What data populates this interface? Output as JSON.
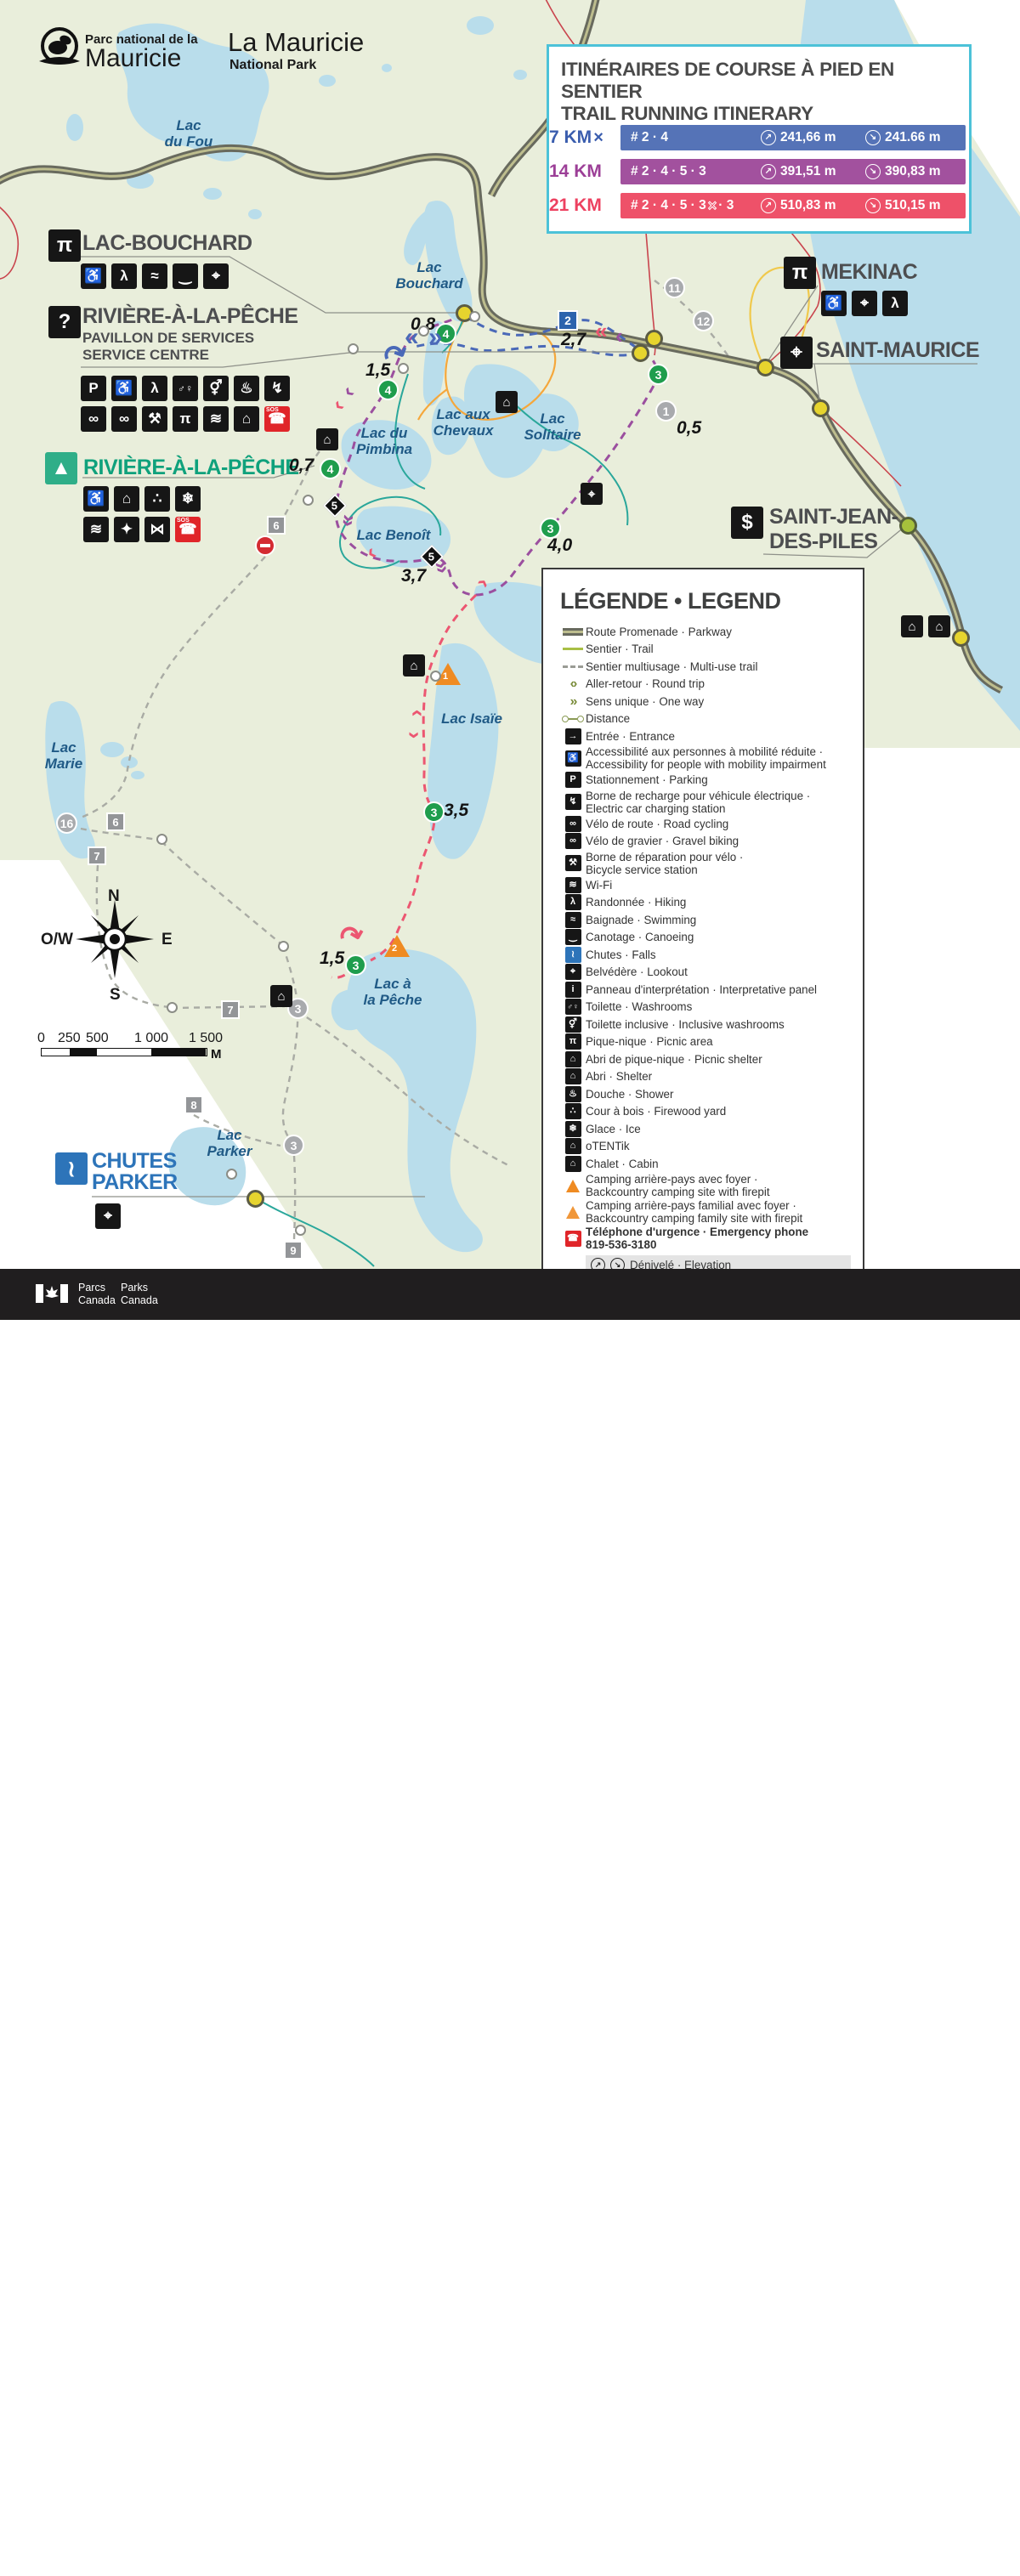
{
  "header": {
    "logo_fr_small": "Parc national de la",
    "logo_fr_big": "Mauricie",
    "logo_en_big": "La Mauricie",
    "logo_en_small": "National Park"
  },
  "itinerary": {
    "title_fr": "ITINÉRAIRES DE COURSE À PIED EN SENTIER",
    "title_en": "TRAIL RUNNING ITINERARY",
    "accent_border": "#4cc2d8",
    "rows": [
      {
        "distance": "7 KM",
        "cross": "×",
        "segments": "# 2 · 4",
        "gain": "241,66 m",
        "loss": "241.66 m",
        "color": "#5573b7"
      },
      {
        "distance": "14 KM",
        "segments": "# 2 · 4 · 5 · 3",
        "gain": "391,51 m",
        "loss": "390,83 m",
        "color": "#a2519e"
      },
      {
        "distance": "21 KM",
        "segments_pre": "# 2 · 4 · 5 · 3",
        "cross": "×",
        "segments_post": "· 3",
        "gain": "510,83 m",
        "loss": "510,15 m",
        "color": "#ee5169"
      }
    ],
    "gain_arrow": "↗",
    "loss_arrow": "↘"
  },
  "legend": {
    "title": "LÉGENDE • LEGEND",
    "items": [
      {
        "label": "Route Promenade · Parkway"
      },
      {
        "label": "Sentier · Trail"
      },
      {
        "label": "Sentier multiusage · Multi-use trail"
      },
      {
        "label": "Aller-retour · Round trip",
        "glyph": "‹›"
      },
      {
        "label": "Sens unique · One way",
        "glyph": "»"
      },
      {
        "label": "Distance"
      },
      {
        "label": "Entrée · Entrance",
        "glyph": "→"
      },
      {
        "label": "Accessibilité aux personnes à mobilité réduite ·\nAccessibility for people with mobility impairment",
        "glyph": "♿"
      },
      {
        "label": "Stationnement · Parking",
        "glyph": "P"
      },
      {
        "label": "Borne de recharge pour véhicule électrique ·\nElectric car charging station",
        "glyph": "↯"
      },
      {
        "label": "Vélo de route · Road cycling",
        "glyph": "∞"
      },
      {
        "label": "Vélo de gravier · Gravel biking",
        "glyph": "∞"
      },
      {
        "label": "Borne de réparation pour vélo ·\nBicycle service station",
        "glyph": "⚒"
      },
      {
        "label": "Wi-Fi",
        "glyph": "≋"
      },
      {
        "label": "Randonnée · Hiking",
        "glyph": "λ"
      },
      {
        "label": "Baignade · Swimming",
        "glyph": "≈"
      },
      {
        "label": "Canotage · Canoeing",
        "glyph": "‿"
      },
      {
        "label": "Chutes · Falls",
        "glyph": "≀"
      },
      {
        "label": "Belvédère · Lookout",
        "glyph": "⌖"
      },
      {
        "label": "Panneau d'interprétation · Interpretative panel",
        "glyph": "i"
      },
      {
        "label": "Toilette · Washrooms",
        "glyph": "♂♀"
      },
      {
        "label": "Toilette inclusive · Inclusive washrooms",
        "glyph": "⚥"
      },
      {
        "label": "Pique-nique · Picnic area",
        "glyph": "π"
      },
      {
        "label": "Abri de pique-nique · Picnic shelter",
        "glyph": "⌂"
      },
      {
        "label": "Abri · Shelter",
        "glyph": "⌂"
      },
      {
        "label": "Douche · Shower",
        "glyph": "♨"
      },
      {
        "label": "Cour à bois · Firewood yard",
        "glyph": "∴"
      },
      {
        "label": "Glace · Ice",
        "glyph": "❄"
      },
      {
        "label": "oTENTik",
        "glyph": "⌂"
      },
      {
        "label": "Chalet · Cabin",
        "glyph": "⌂"
      },
      {
        "label": "Camping arrière-pays avec foyer ·\nBackcountry camping site with firepit"
      },
      {
        "label": "Camping arrière-pays familial avec foyer ·\nBackcountry camping family site with firepit"
      },
      {
        "label": "Téléphone d'urgence · Emergency phone\n819-536-3180",
        "glyph": "☎"
      },
      {
        "label": "Dénivelé · Elevation",
        "g1": "↗",
        "g2": "↘"
      }
    ]
  },
  "glyphs": {
    "wheelchair": "♿",
    "hiker": "λ",
    "swim": "≈",
    "canoe": "‿",
    "lookout": "⌖",
    "parking": "P",
    "toilets": "♂♀",
    "toilet_incl": "⚥",
    "shower": "♨",
    "ev": "↯",
    "bike": "∞",
    "repair": "⚒",
    "picnic": "π",
    "wifi": "≋",
    "shelter": "⌂",
    "phone": "☎",
    "sos": "SOS",
    "question": "?",
    "tent": "▲",
    "house": "⌂",
    "firewood": "∴",
    "ice": "❄",
    "play": "✦",
    "fish": "⋈",
    "kiosk": "$",
    "falls": "≀",
    "cabin": "⌂",
    "entrance": "→",
    "chev_r": "»",
    "chev_l": "«",
    "chev1_r": "›",
    "chev1_l": "‹",
    "uturn": "↷"
  },
  "callouts": {
    "lac_bouchard": {
      "title": "LAC-BOUCHARD"
    },
    "rap_services": {
      "title": "RIVIÈRE-À-LA-PÊCHE",
      "sub1": "PAVILLON DE SERVICES",
      "sub2": "SERVICE CENTRE"
    },
    "rap_camp": {
      "title": "RIVIÈRE-À-LA-PÊCHE"
    },
    "mekinac": {
      "title": "MEKINAC"
    },
    "saint_maurice": {
      "title": "SAINT-MAURICE"
    },
    "saint_jean": {
      "title": "SAINT-JEAN-\nDES-PILES"
    },
    "chutes_parker": {
      "title": "CHUTES\nPARKER"
    }
  },
  "map": {
    "lakes": [
      "Lac\ndu Fou",
      "Lac\nBouchard",
      "Lac aux\nChevaux",
      "Lac\nSolitaire",
      "Lac du\nPimbina",
      "Lac Benoît",
      "Lac Isaïe",
      "Lac\nMarie",
      "Lac à\nla Pêche",
      "Lac\nParker"
    ],
    "distances": [
      "0,8",
      "2,7",
      "1,5",
      "0,7",
      "0,5",
      "4,0",
      "3,7",
      "3,5",
      "1,5"
    ],
    "markers": {
      "green": [
        "4",
        "4",
        "4",
        "3",
        "3",
        "3",
        "3"
      ],
      "blue_square": "2",
      "diamonds": [
        "5",
        "5"
      ],
      "gray_circles": [
        "11",
        "12",
        "1",
        "16",
        "3",
        "3"
      ],
      "gray_squares": [
        "6",
        "6",
        "7",
        "7",
        "8",
        "9"
      ],
      "triangles": [
        "1",
        "2"
      ]
    }
  },
  "compass": {
    "n": "N",
    "e": "E",
    "s": "S",
    "w": "O/W"
  },
  "scalebar": {
    "ticks": [
      "0",
      "250",
      "500",
      "1 000",
      "1 500"
    ],
    "unit": "M"
  },
  "footer": {
    "parcs": "Parcs\nCanada",
    "parks": "Parks\nCanada",
    "wordmark": "Canada"
  }
}
